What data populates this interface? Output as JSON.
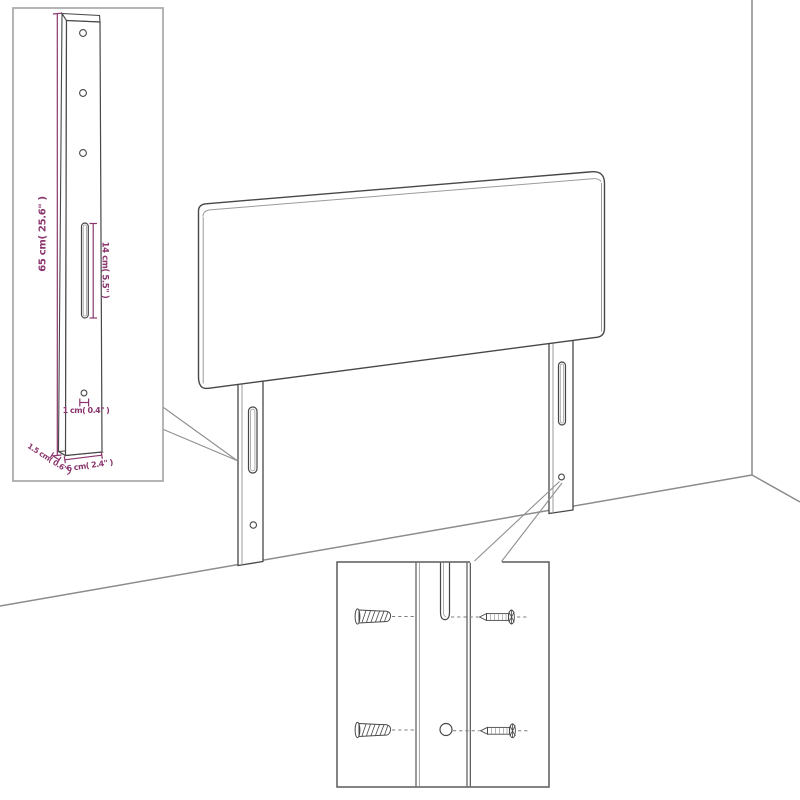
{
  "diagram": {
    "description": "Exploded dimension diagram of an upholstered headboard with two slotted mounting legs shown against a wall corner, with a leg-dimension inset (top left) and a wall-plug/screw mounting inset (bottom right)",
    "colors": {
      "dimension_text": "#8a356d",
      "product_line": "#474747",
      "wall_line": "#8c8c8c",
      "inset_border_light": "#a8a8a8",
      "inset_border_dark": "#5a5a5a"
    },
    "labels": {
      "leg_height": "65 cm( 25.6\" )",
      "slot_length": "14 cm( 5.5\" )",
      "hole_size": "1 cm( 0.4\" )",
      "leg_thickness": "1.5 cm( 0.6\" )",
      "leg_width": "6 cm( 2.4\" )"
    },
    "parts": {
      "main_view": "headboard panel with two slotted legs standing against wall corner",
      "inset_top_left": "mounting leg with dimension callouts",
      "inset_bottom_right": "wall plugs and screws aligned with leg slot and hole"
    }
  }
}
